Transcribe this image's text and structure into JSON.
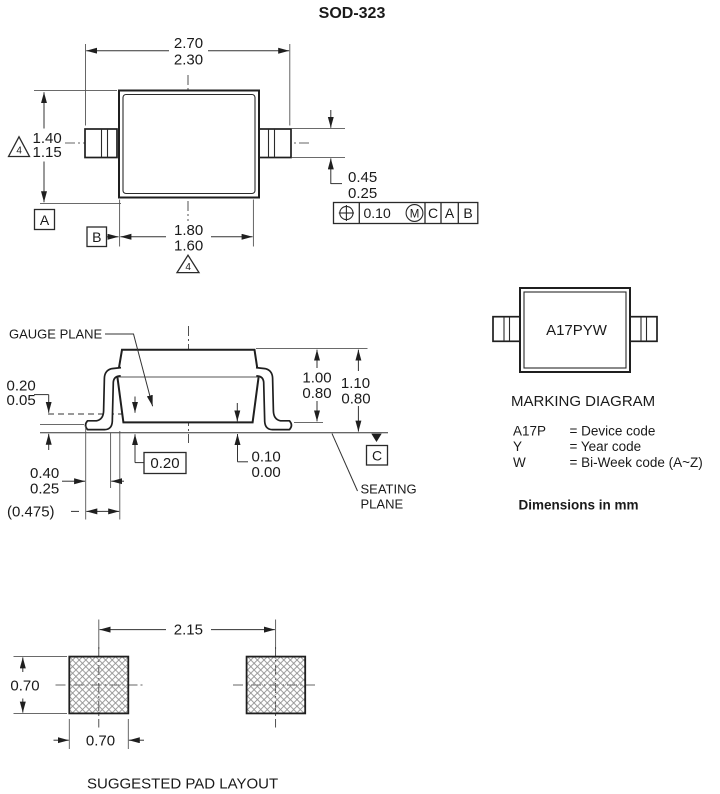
{
  "title": "SOD-323",
  "colors": {
    "ink": "#1a1a1a",
    "line": "#333333",
    "hatch": "#8f8f8f"
  },
  "top_view": {
    "width_max": "2.70",
    "width_min": "2.30",
    "height_max": "1.40",
    "height_min": "1.15",
    "body_width_max": "1.80",
    "body_width_min": "1.60",
    "lead_width_max": "0.45",
    "lead_width_min": "0.25",
    "note_left": "4",
    "note_bottom": "4",
    "datum_a": "A",
    "datum_b": "B",
    "fcf": {
      "tolerance": "0.10",
      "modifier": "M",
      "datum1": "C",
      "datum2": "A",
      "datum3": "B"
    }
  },
  "side_view": {
    "gauge_plane_label": "GAUGE PLANE",
    "standoff_max": "0.20",
    "standoff_min": "0.05",
    "gauge_ref": "0.20",
    "clearance_max": "0.10",
    "clearance_min": "0.00",
    "body_height_max": "1.00",
    "body_height_min": "0.80",
    "total_height_max": "1.10",
    "total_height_min": "0.80",
    "foot_max": "0.40",
    "foot_min": "0.25",
    "lead_ref": "(0.475)",
    "datum_c": "C",
    "seating_line1": "SEATING",
    "seating_line2": "PLANE"
  },
  "marking": {
    "code": "A17PYW",
    "heading": "MARKING DIAGRAM",
    "legend": [
      {
        "key": "A17P",
        "desc": "= Device code"
      },
      {
        "key": "Y",
        "desc": "= Year code"
      },
      {
        "key": "W",
        "desc": "= Bi-Week code (A~Z)"
      }
    ],
    "units_note": "Dimensions in mm"
  },
  "pad_layout": {
    "pitch": "2.15",
    "pad_height": "0.70",
    "pad_width": "0.70",
    "heading": "SUGGESTED PAD LAYOUT"
  }
}
